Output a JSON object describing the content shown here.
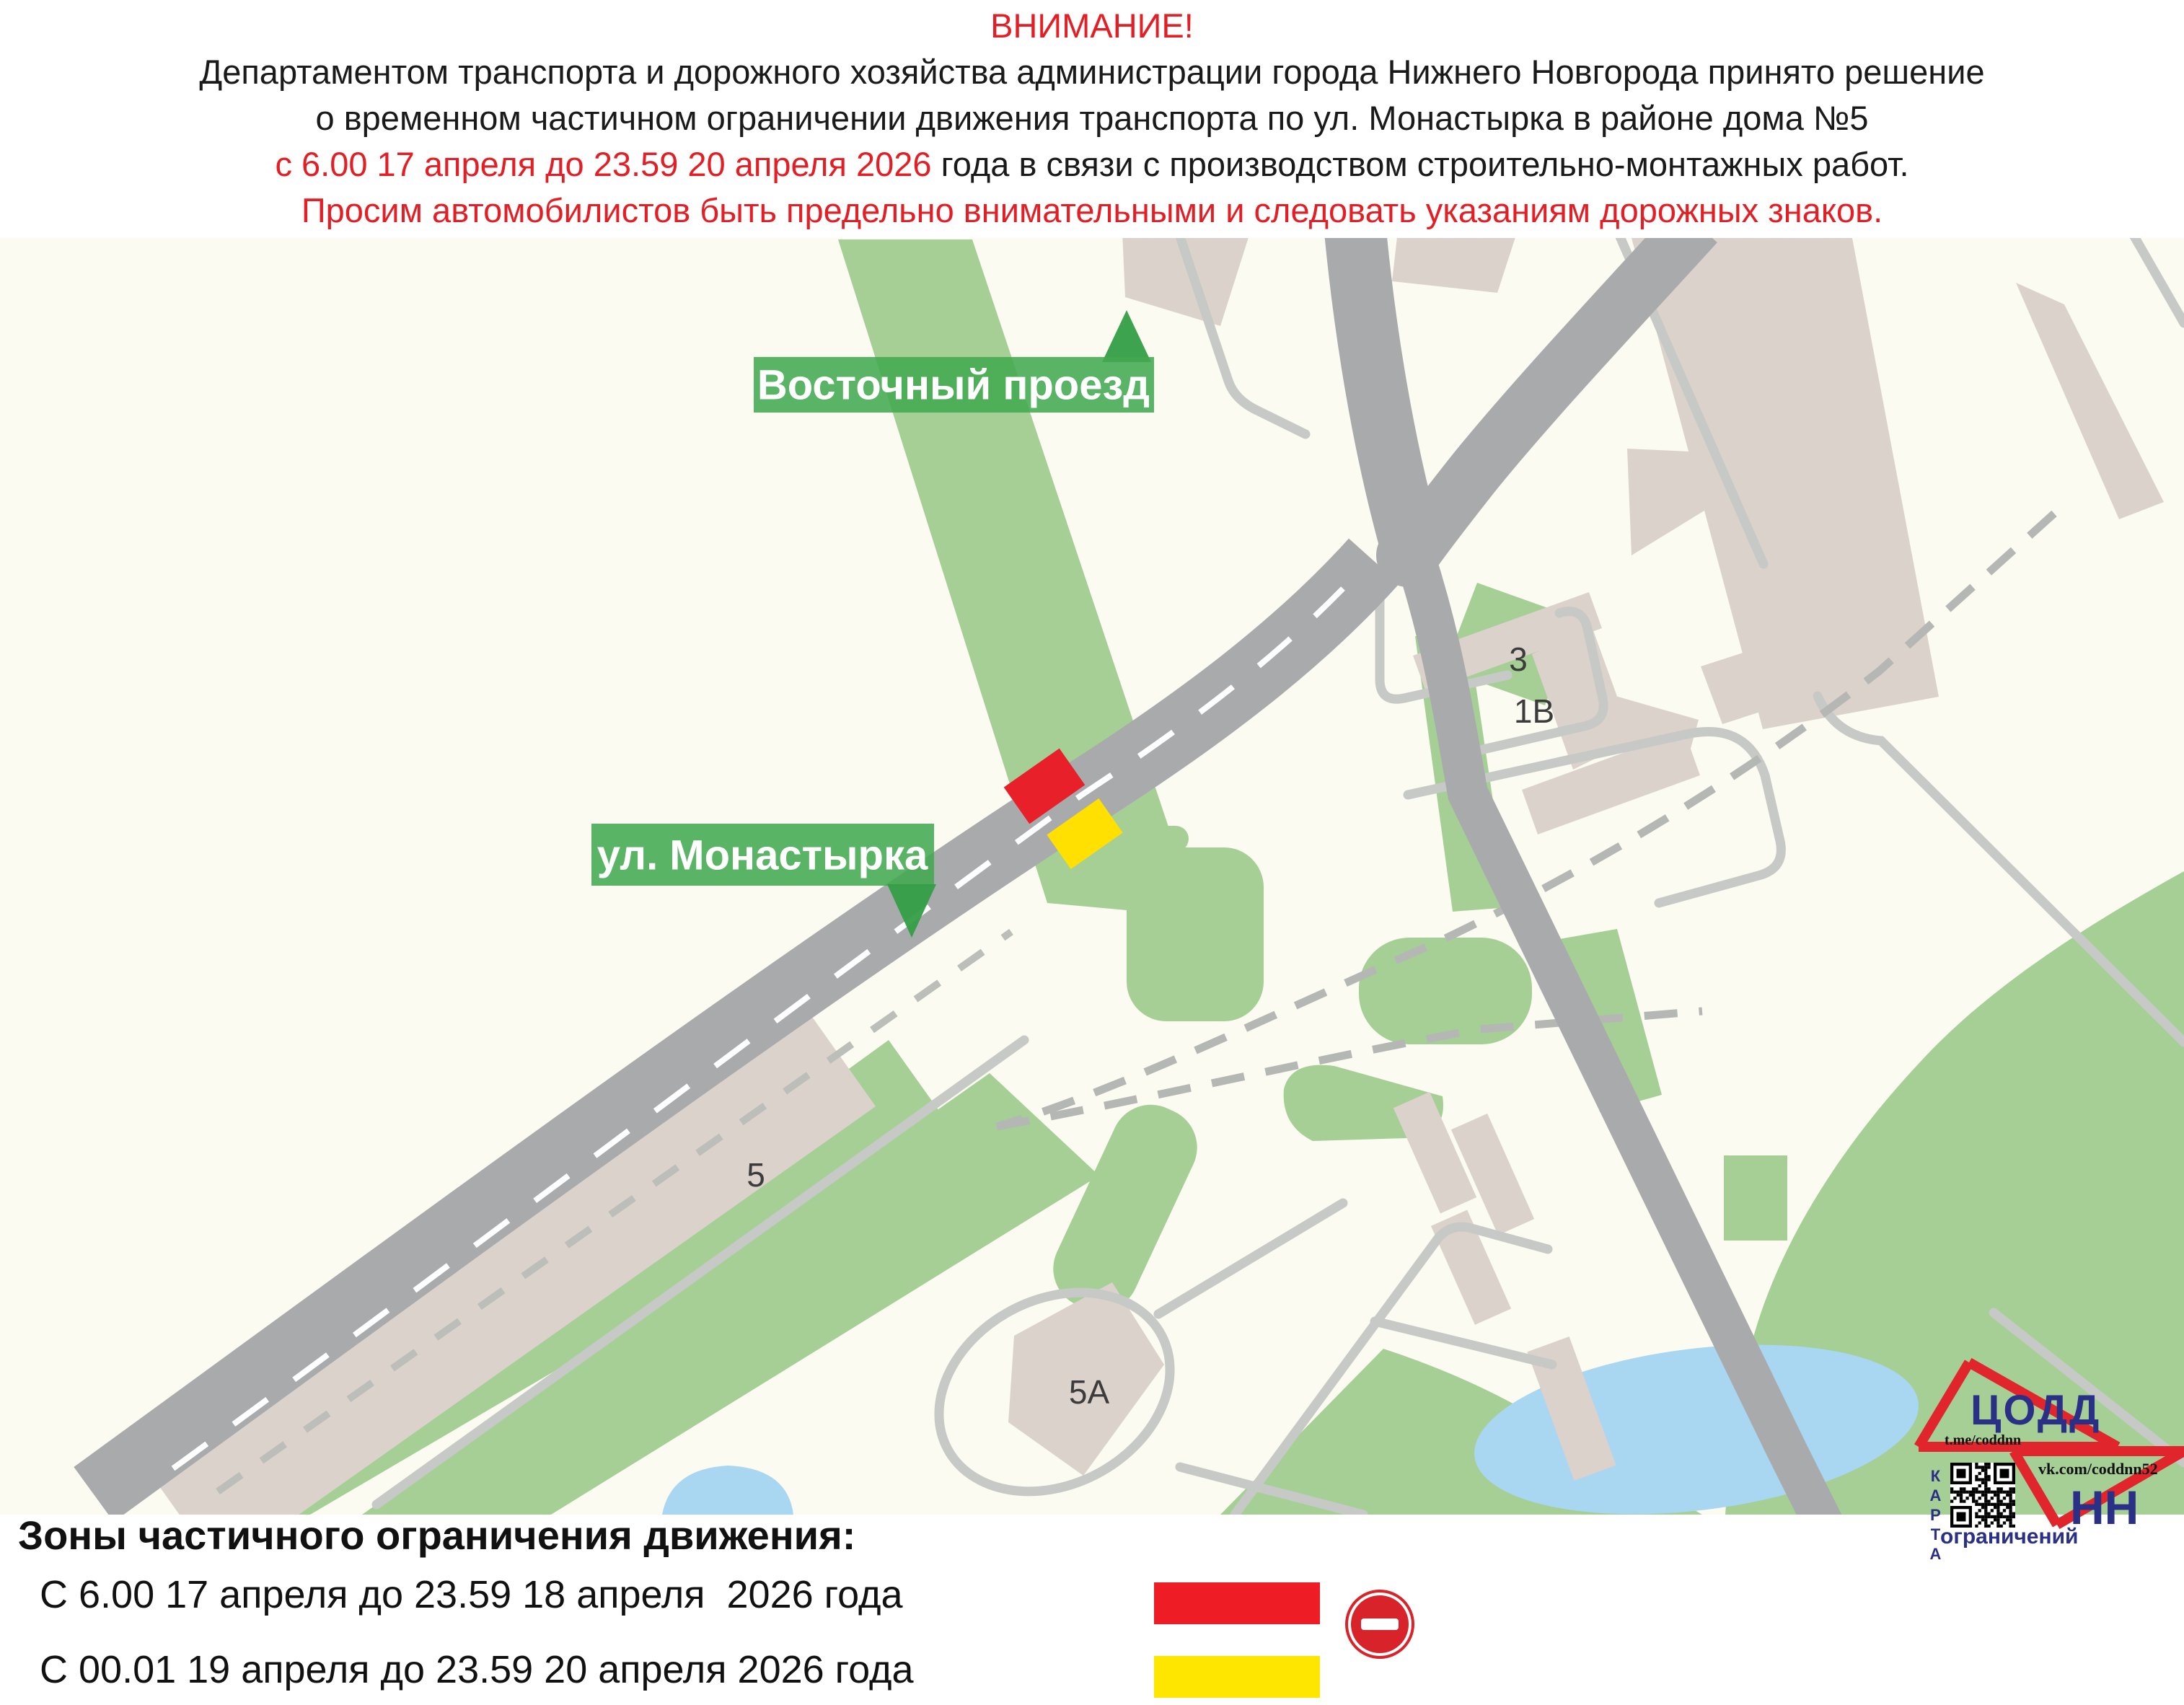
{
  "header": {
    "attention": "ВНИМАНИЕ!",
    "line1": "Департаментом транспорта и дорожного хозяйства администрации города Нижнего Новгорода принято решение",
    "line2": "о временном частичном ограничении движения транспорта по ул. Монастырка в районе дома №5",
    "line3_red": "с 6.00 17 апреля до 23.59 20 апреля 2026",
    "line3_black": " года в связи с производством строительно-монтажных работ.",
    "line4": "Просим автомобилистов быть предельно внимательными и следовать указаниям дорожных знаков."
  },
  "map": {
    "street_labels": [
      {
        "name": "vostochny-proezd",
        "text": "Восточный проезд"
      },
      {
        "name": "ul-monastyrka",
        "text": "ул. Монастырка"
      }
    ],
    "building_labels": [
      {
        "text": "3"
      },
      {
        "text": "1В"
      },
      {
        "text": "5"
      },
      {
        "text": "5А"
      }
    ],
    "markers": [
      {
        "name": "restriction-zone-1",
        "color": "#e8202a"
      },
      {
        "name": "restriction-zone-2",
        "color": "#ffe000"
      }
    ],
    "colors": {
      "green_area": "#a6cf96",
      "road_gray": "#a8aaac",
      "building_beige": "#dbd2cc",
      "pond_blue": "#a9d6f0",
      "badge_green": "#42a94f"
    }
  },
  "legend": {
    "title": "Зоны частичного ограничения движения:",
    "items": [
      {
        "period": "С 6.00 17 апреля до 23.59 18 апреля  2026 года",
        "color": "#ee1c25"
      },
      {
        "period": "С 00.01 19 апреля до 23.59 20 апреля 2026 года",
        "color": "#ffe600"
      }
    ],
    "no_entry_icon": "no-entry-sign"
  },
  "logo": {
    "org": "ЦОДД",
    "city": "НН",
    "telegram": "t.me/coddnn",
    "vk": "vk.com/coddnn52",
    "karta": "КАРТА",
    "restrictions": "ограничений",
    "accent_red": "#e0262c",
    "navy": "#2b3087"
  }
}
